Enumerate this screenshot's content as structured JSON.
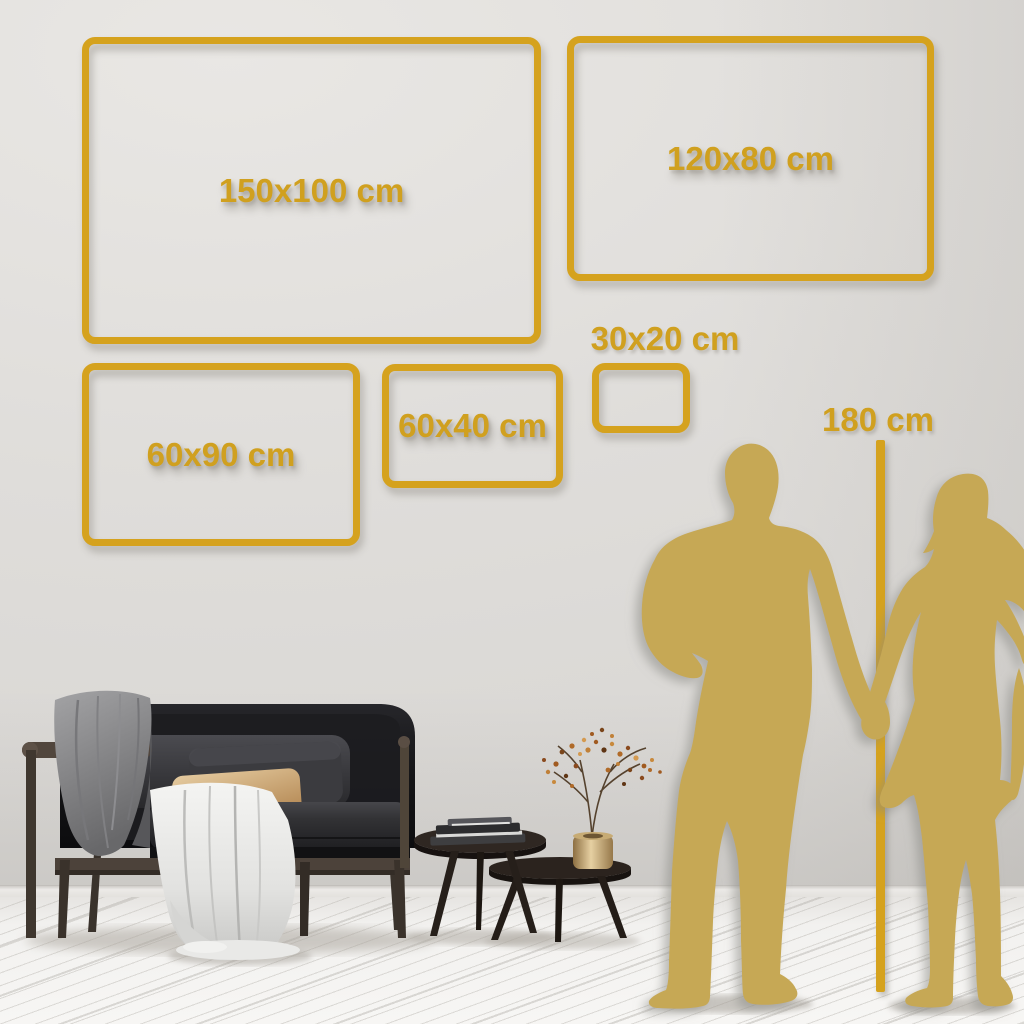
{
  "infographic": {
    "subject": "wall-art-size-guide",
    "labels": {
      "s150x100": "150x100 cm",
      "s120x80": "120x80 cm",
      "s60x90": "60x90 cm",
      "s60x40": "60x40 cm",
      "s30x20": "30x20 cm",
      "person_height": "180 cm"
    },
    "sizes_cm": [
      {
        "label": "150x100 cm",
        "width_cm": 150,
        "height_cm": 100
      },
      {
        "label": "120x80 cm",
        "width_cm": 120,
        "height_cm": 80
      },
      {
        "label": "60x90 cm",
        "width_cm": 60,
        "height_cm": 90
      },
      {
        "label": "60x40 cm",
        "width_cm": 60,
        "height_cm": 40
      },
      {
        "label": "30x20 cm",
        "width_cm": 30,
        "height_cm": 20
      }
    ],
    "reference": {
      "person_height_cm": 180,
      "figure": "couple-silhouette-holding-hands"
    },
    "colors": {
      "accent_gold": "#D5A21E",
      "silhouette_gold": "#C6A855",
      "wall": "#DFDDDA",
      "floor": "#F2F1EF",
      "sofa": "#141416",
      "throw_blanket": "#8C8C8E",
      "draped_cloth": "#EDEDEB",
      "accent_pillow": "#D2AC79",
      "wood_frame": "#4C423A",
      "vase_brass": "#D9C291"
    },
    "scene_objects": [
      "sofa",
      "throw-blanket",
      "draped-cloth",
      "lumbar-pillow",
      "nesting-coffee-tables",
      "books",
      "brass-vase",
      "dried-branch",
      "couple-silhouette",
      "height-reference-line",
      "plank-floor"
    ]
  }
}
